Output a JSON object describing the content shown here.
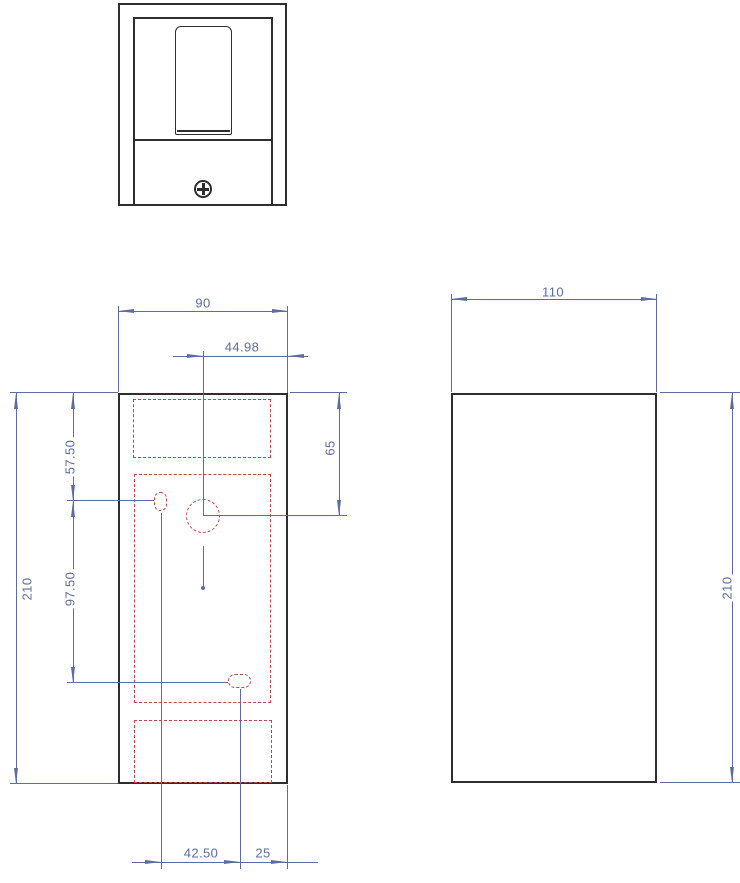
{
  "drawing": {
    "dimensions": {
      "front_width": "90",
      "hole_offset": "44.98",
      "height_left": "210",
      "top_to_slot": "57.50",
      "slot_spacing": "97.50",
      "top_to_hole": "65",
      "slot_offset_bottom": "42.50",
      "slot_to_right_edge": "25",
      "side_depth": "110",
      "height_right": "210"
    },
    "icons": {
      "screw": "phillips-screw"
    },
    "colors": {
      "dimension": "#5d6da1",
      "hidden": "#c04848",
      "outline": "#2e2e2e",
      "background": "#ffffff"
    }
  }
}
